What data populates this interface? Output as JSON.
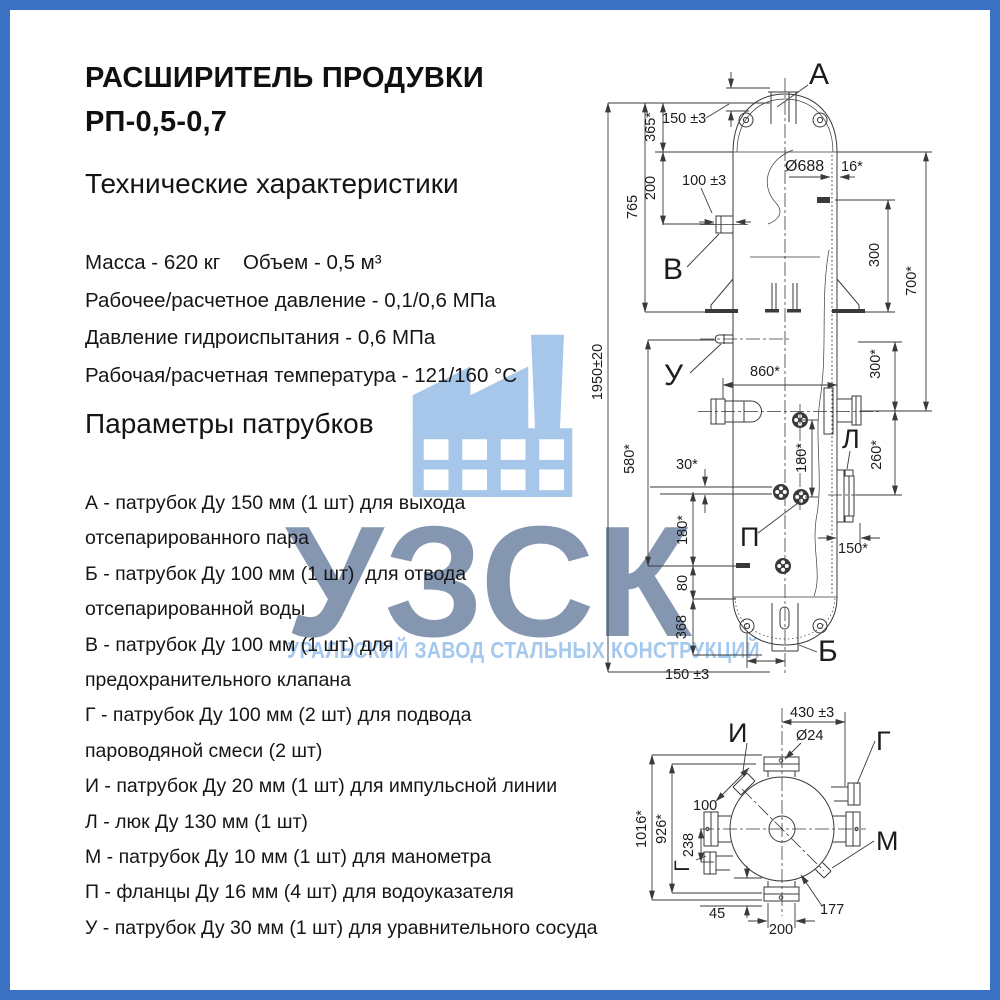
{
  "page": {
    "border_color": "#3b72c3",
    "background": "#ffffff"
  },
  "title": {
    "line1": "РАСШИРИТЕЛЬ ПРОДУВКИ",
    "line2": "РП-0,5-0,7"
  },
  "tech": {
    "heading": "Технические характеристики",
    "specs": [
      "Масса - 620 кг    Объем - 0,5 м³",
      "Рабочее/расчетное давление - 0,1/0,6 МПа",
      "Давление гидроиспытания - 0,6 МПа",
      "Рабочая/расчетная температура - 121/160 °С"
    ]
  },
  "nozzles": {
    "heading": "Параметры патрубков",
    "lines": [
      "А - патрубок Ду 150 мм (1 шт) для выхода",
      "отсепарированного пара",
      "Б - патрубок Ду 100 мм (1 шт)  для отвода",
      "отсепарированной воды",
      "В - патрубок Ду 100 мм (1 шт) для",
      "предохранительного клапана",
      "Г - патрубок Ду 100 мм (2 шт) для подвода",
      "пароводяной смеси (2 шт)",
      "И - патрубок Ду 20 мм (1 шт) для импульсной линии",
      "Л - люк Ду 130 мм (1 шт)",
      "М - патрубок Ду 10 мм (1 шт) для манометра",
      "П - фланцы Ду 16 мм (4 шт) для водоуказателя",
      "У - патрубок Ду 30 мм (1 шт) для уравнительного сосуда"
    ]
  },
  "watermark": {
    "abbr": "УЗСК",
    "subtitle": "УРАЛЬСКИЙ ЗАВОД СТАЛЬНЫХ КОНСТРУКЦИЙ",
    "icon": "factory-icon",
    "icon_color": "#a6c7ea",
    "abbr_color": "#8496b0",
    "subtitle_color": "#a5c8ee"
  },
  "drawing": {
    "labels": {
      "a": "А",
      "b": "Б",
      "v": "В",
      "g": "Г",
      "i": "И",
      "l": "Л",
      "m": "М",
      "p": "П",
      "u": "У"
    },
    "dims": {
      "h1950": "1950±20",
      "h765": "765",
      "h365": "365*",
      "h200": "200",
      "a150": "150 ±3",
      "b100": "100 ±3",
      "dia688": "Ø688",
      "t16": "16*",
      "r300a": "300",
      "r700": "700*",
      "w860": "860*",
      "v580": "580*",
      "r300b": "300*",
      "r260": "260*",
      "o30": "30*",
      "p180": "180*",
      "l180": "180*",
      "l80": "80",
      "l368": "368",
      "r150": "150*",
      "bot150": "150 ±3",
      "s430": "430 ±3",
      "s24": "Ø24",
      "s100": "100",
      "s1016": "1016*",
      "s926": "926*",
      "s238": "238",
      "s45": "45",
      "s200": "200",
      "s177": "177"
    }
  }
}
